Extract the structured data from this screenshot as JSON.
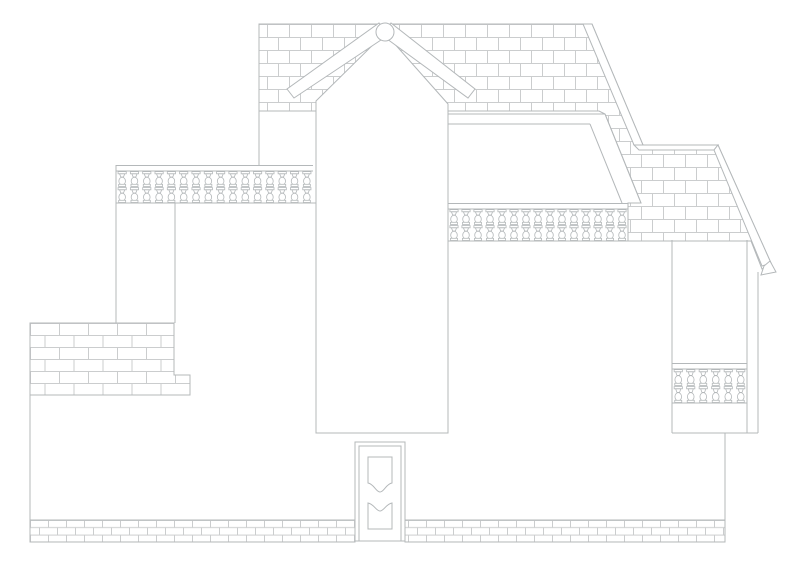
{
  "meta": {
    "drawing_type": "architectural-front-elevation",
    "description": "CAD-style line drawing of a two-storey house front elevation with shingled roofs, three balcony balustrades, brick terrace, brick base course and a panelled entry door",
    "text_content": "none (drawing contains no visible text)"
  },
  "canvas": {
    "width": 800,
    "height": 575,
    "background": "#ffffff"
  },
  "colors": {
    "outline": "#b4b8ba",
    "pattern_line": "#cbcdce",
    "surface": "#ffffff"
  },
  "patterns": {
    "roof_shingles": {
      "unit_width": 22,
      "row_height": 13
    },
    "brick_large": {
      "unit_width": 29,
      "row_height": 12
    },
    "brick_small": {
      "unit_width": 18,
      "row_height": 7.3
    }
  },
  "balustrades": [
    {
      "id": "balustrade-left",
      "x": 116,
      "y": 165,
      "width": 197,
      "height": 38,
      "rail_height": 6,
      "balusters": 16
    },
    {
      "id": "balustrade-middle",
      "x": 448,
      "y": 203,
      "width": 180,
      "height": 38,
      "rail_height": 6,
      "balusters": 15
    },
    {
      "id": "balustrade-right",
      "x": 672,
      "y": 363,
      "width": 75,
      "height": 40,
      "rail_height": 6,
      "balusters": 6
    }
  ],
  "door": {
    "x": 355,
    "y": 442,
    "width": 50,
    "height": 99,
    "panels": 2
  },
  "gable": {
    "finial_circle": {
      "cx": 385,
      "cy": 32,
      "r": 9
    }
  },
  "components": [
    "upper-roof-shingle-band",
    "stepped-hip-roof-right",
    "gable-rafters",
    "gable-finial",
    "central-tower",
    "middle-awning",
    "left-balcony-balustrade",
    "middle-balcony-balustrade",
    "right-loggia-balustrade",
    "brick-terrace-left",
    "entry-door",
    "brick-base-course",
    "roof-eave-gutter-end"
  ]
}
